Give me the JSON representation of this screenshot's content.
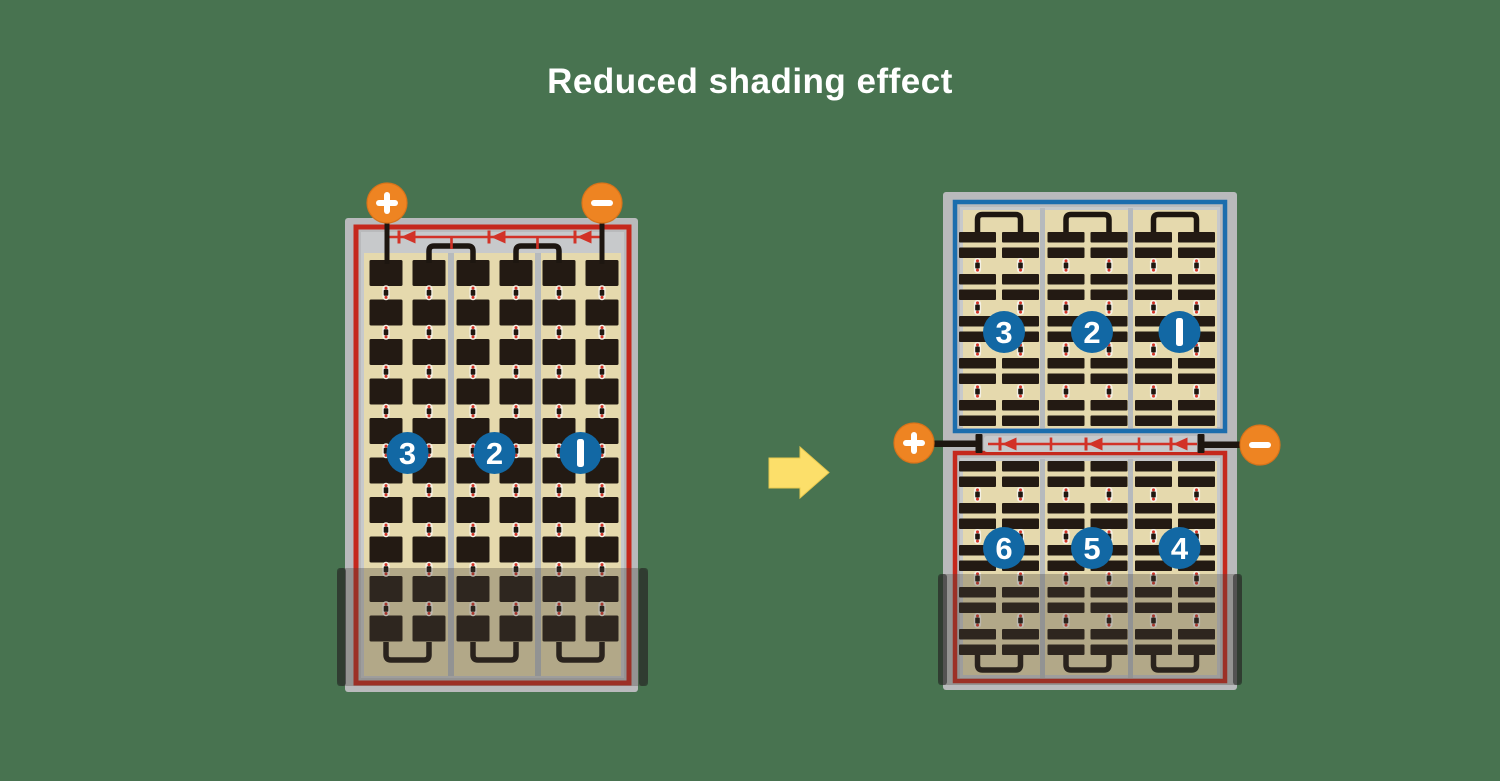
{
  "title": "Reduced shading effect",
  "terminals": {
    "plus": "+",
    "minus": "−"
  },
  "left_panel": {
    "description": "conventional full-cell panel, whole panel affected by bottom shading",
    "strings": [
      "3",
      "2",
      "1"
    ],
    "cell_rows": 10,
    "cell_columns": 6,
    "bypass_diodes": 3,
    "shaded_portion": "bottom rows"
  },
  "right_panel": {
    "description": "half-cut cell panel split in two halves, only lower half affected by shading",
    "top_strings": [
      "3",
      "2",
      "1"
    ],
    "bottom_strings": [
      "6",
      "5",
      "4"
    ],
    "bar_row_groups_per_half": 5,
    "cell_columns": 6,
    "bypass_diodes": 3,
    "shaded_portion": "bottom rows of lower half"
  },
  "arrow": {
    "direction": "right"
  },
  "colors": {
    "background": "#487350",
    "frame": "#b9babc",
    "frame_edge": "#a8aaac",
    "panel_bg": "#e5d9ad",
    "strip_gray": "#c7c9cb",
    "divider": "#b6babd",
    "cell": "#231a13",
    "busbar": "#1d1610",
    "red": "#c5281c",
    "diode_red": "#d23227",
    "blue": "#1b6dad",
    "circle_blue": "#1268a4",
    "orange": "#ee8422",
    "orange_edge": "#d8731a",
    "arrow_yellow": "#fcdf6a",
    "shade": "rgba(70,64,58,0.32)",
    "shade_wing": "rgba(30,30,30,0.55)",
    "label_white": "#ffffff"
  }
}
